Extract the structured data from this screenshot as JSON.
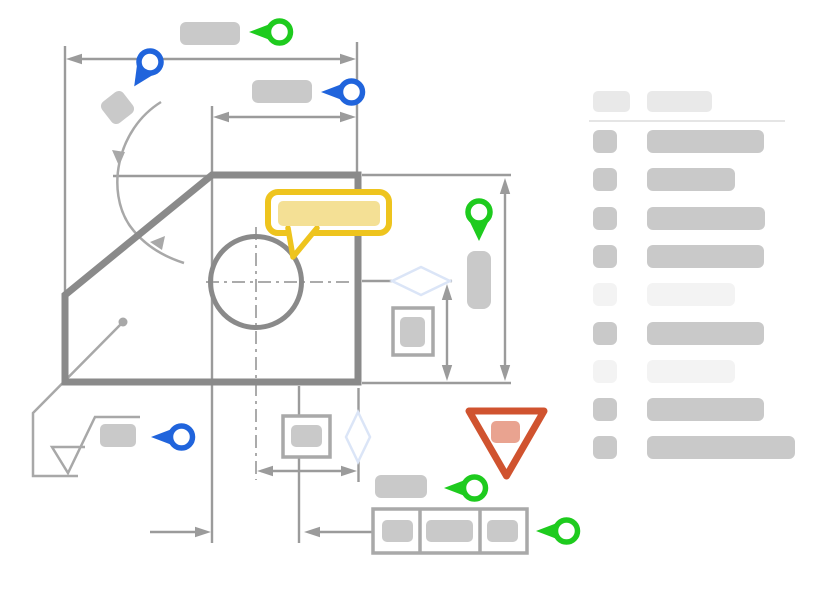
{
  "colors": {
    "canvas_bg": "#ffffff",
    "green": "#1ecb1e",
    "blue": "#2064dc",
    "yellow": "#eec41e",
    "yellow_light": "#f4e095",
    "red": "#d0532f",
    "red_light": "#e9a390",
    "diamond_blue": "#dbe5f7",
    "outline_gray": "#8a8a8a",
    "dim_gray": "#9b9b9b",
    "center_gray": "#ababab",
    "leader_gray": "#a8a8a8",
    "box_gray": "#a9a9a9",
    "ph_gray": "#c9c9c9",
    "ph_light": "#f3f3f3",
    "header_gray": "#e9e9e9",
    "divider_gray": "#e5e5e5"
  },
  "sidebar": {
    "header": {
      "icon_width": 37,
      "label_width": 65
    },
    "row_pitch": 38.3,
    "rows": [
      {
        "tone": "medium",
        "bar_width": 117
      },
      {
        "tone": "medium",
        "bar_width": 88
      },
      {
        "tone": "medium",
        "bar_width": 118
      },
      {
        "tone": "medium",
        "bar_width": 117
      },
      {
        "tone": "light",
        "bar_width": 88
      },
      {
        "tone": "medium",
        "bar_width": 117
      },
      {
        "tone": "light",
        "bar_width": 88
      },
      {
        "tone": "medium",
        "bar_width": 117
      },
      {
        "tone": "medium",
        "bar_width": 148
      }
    ]
  },
  "annotations": {
    "pins": [
      {
        "id": "pin-overall-width",
        "color": "green",
        "direction": "left"
      },
      {
        "id": "pin-angle",
        "color": "blue",
        "direction": "down-left"
      },
      {
        "id": "pin-partial-width",
        "color": "blue",
        "direction": "left"
      },
      {
        "id": "pin-height",
        "color": "green",
        "direction": "down"
      },
      {
        "id": "pin-surface-finish",
        "color": "blue",
        "direction": "left"
      },
      {
        "id": "pin-bottom-label",
        "color": "green",
        "direction": "left"
      },
      {
        "id": "pin-feature-control-frame",
        "color": "green",
        "direction": "left"
      }
    ],
    "comment_bubble": {
      "shape": "speech-bubble"
    },
    "warning_marker": {
      "shape": "inverted-triangle"
    }
  }
}
